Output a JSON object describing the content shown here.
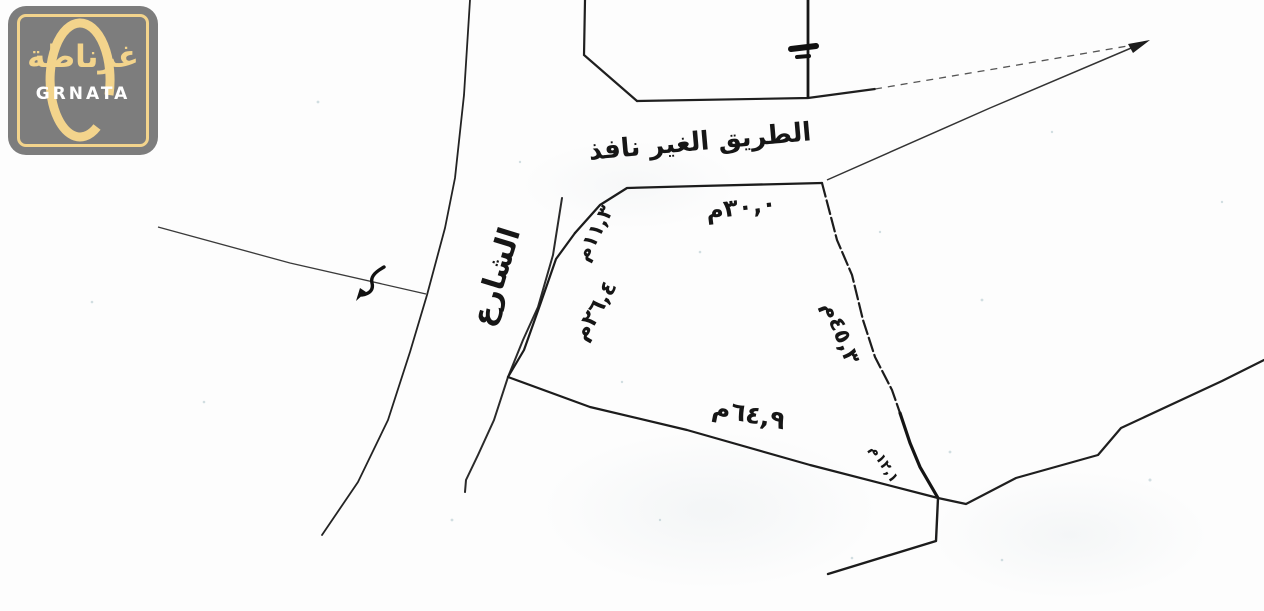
{
  "page": {
    "background_color": "#fdfdfd",
    "ink_color": "#1c1c1c"
  },
  "logo": {
    "arabic_name": "غرناطة",
    "latin_name": "GRNATA",
    "colors": {
      "badge_gray": "#7d7d7d",
      "gold": "#f3d48c",
      "latin_text_white": "#ffffff"
    }
  },
  "sketch": {
    "street_label": "الشارع",
    "lane_label": "الطريق الغير نافذ",
    "measurements": {
      "top_edge": "٣٠,٠م",
      "left_upper_edge": "١١,٣م",
      "left_lower_edge": "٢٦,٤م",
      "bottom_edge": "٦٤,٩م",
      "right_edge": "٤٥,٣م",
      "right_lower_edge": "١٢,١م"
    }
  }
}
